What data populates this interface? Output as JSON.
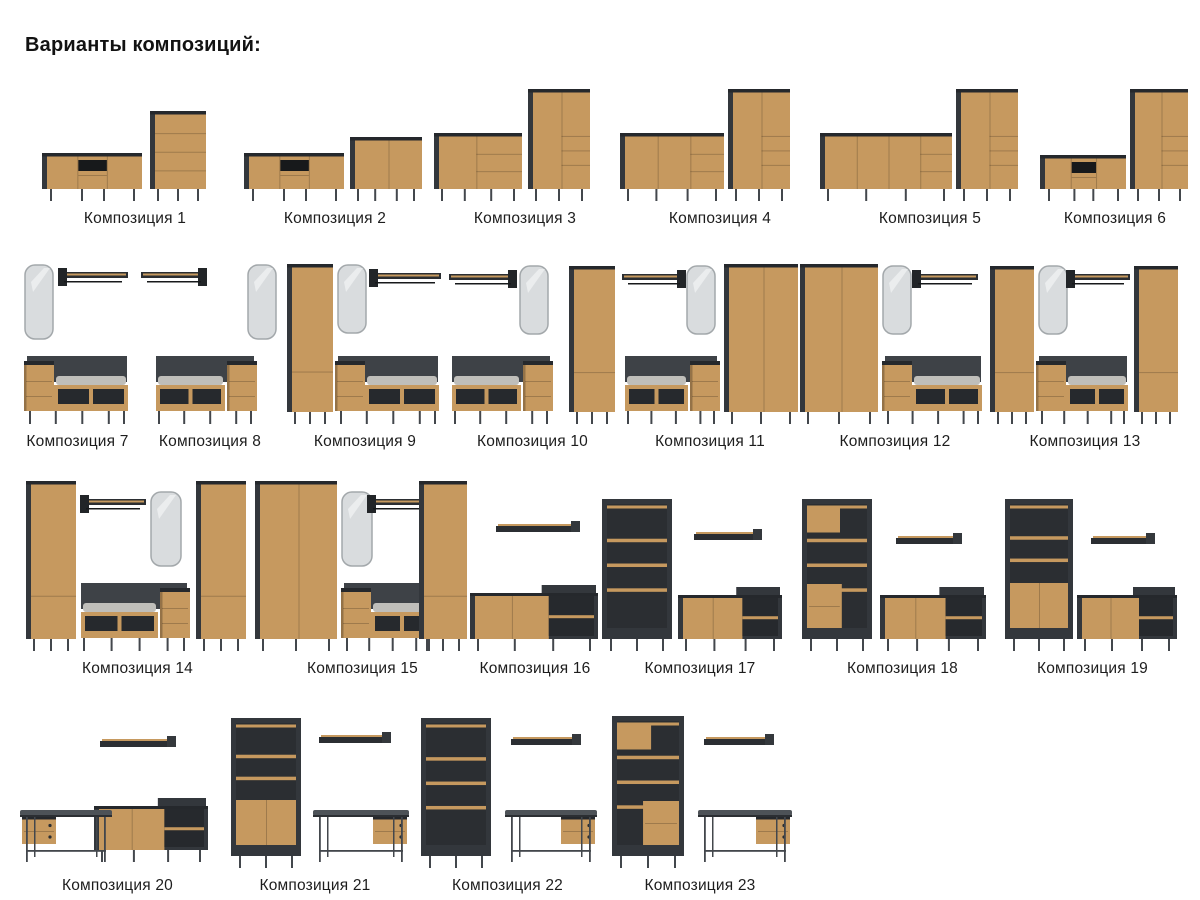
{
  "page": {
    "title": "Варианты композиций:"
  },
  "colors": {
    "oak": "#c6995f",
    "carcass": "#33373c",
    "carcassDark": "#25282c",
    "inner": "#26292d",
    "leg": "#43474c",
    "cushion": "#bfbeba",
    "mirror": "#d9dcde",
    "deskTop": "#4d5257",
    "ink": "#1d1d1d"
  },
  "rows": [
    {
      "canvas_h": 118,
      "pad": 30,
      "cells": [
        {
          "w": 210,
          "label": "Композиция 1",
          "pieces": [
            {
              "t": "tvstand",
              "x": 12,
              "w": 100,
              "h": 36
            },
            {
              "t": "dresser",
              "x": 120,
              "w": 56,
              "h": 78
            }
          ]
        },
        {
          "w": 190,
          "label": "Композиция 2",
          "pieces": [
            {
              "t": "tvstand",
              "x": 4,
              "w": 100,
              "h": 36
            },
            {
              "t": "sideboard",
              "x": 110,
              "w": 72,
              "h": 52,
              "v": [
                0.5
              ]
            }
          ]
        },
        {
          "w": 190,
          "label": "Композиция 3",
          "pieces": [
            {
              "t": "sideboard",
              "x": 4,
              "w": 88,
              "h": 56,
              "v": [
                0.45
              ],
              "dr": true
            },
            {
              "t": "tallcab",
              "x": 98,
              "w": 62,
              "h": 100
            }
          ]
        },
        {
          "w": 200,
          "label": "Композиция 4",
          "pieces": [
            {
              "t": "sideboard",
              "x": 0,
              "w": 104,
              "h": 56,
              "v": [
                0.33,
                0.66
              ],
              "dr": true
            },
            {
              "t": "tallcab",
              "x": 108,
              "w": 62,
              "h": 100
            }
          ]
        },
        {
          "w": 220,
          "label": "Композиция 5",
          "pieces": [
            {
              "t": "sideboard",
              "x": 0,
              "w": 132,
              "h": 56,
              "v": [
                0.25,
                0.5,
                0.75
              ],
              "dr": true
            },
            {
              "t": "tallcab",
              "x": 136,
              "w": 62,
              "h": 100
            }
          ]
        },
        {
          "w": 150,
          "label": "Композиция 6",
          "pieces": [
            {
              "t": "tvstand",
              "x": 0,
              "w": 86,
              "h": 34
            },
            {
              "t": "tallcab",
              "x": 90,
              "w": 58,
              "h": 100
            }
          ]
        }
      ]
    },
    {
      "canvas_h": 162,
      "pad": 20,
      "cells": [
        {
          "w": 115,
          "label": "Композиция 7",
          "pieces": [
            {
              "t": "mirror",
              "x": 4,
              "top": 2,
              "w": 30,
              "h": 76
            },
            {
              "t": "hanger",
              "x": 38,
              "top": 6,
              "w": 70,
              "side": "l"
            },
            {
              "t": "bench",
              "x": 4,
              "w": 106,
              "side": "left"
            }
          ]
        },
        {
          "w": 150,
          "label": "Композиция 8",
          "pieces": [
            {
              "t": "hanger",
              "x": 6,
              "top": 6,
              "w": 66,
              "side": "r"
            },
            {
              "t": "mirror",
              "x": 112,
              "top": 2,
              "w": 30,
              "h": 76
            },
            {
              "t": "bench",
              "x": 18,
              "w": 104,
              "side": "right"
            }
          ]
        },
        {
          "w": 160,
          "label": "Композиция 9",
          "pieces": [
            {
              "t": "mirror",
              "x": 52,
              "top": 2,
              "w": 30,
              "h": 70
            },
            {
              "t": "hanger",
              "x": 84,
              "top": 7,
              "w": 72,
              "side": "l"
            },
            {
              "t": "wardrobe",
              "x": 2,
              "w": 46,
              "h": 148,
              "doors": 1
            },
            {
              "t": "bench",
              "x": 50,
              "w": 106,
              "side": "left"
            }
          ]
        },
        {
          "w": 175,
          "label": "Композиция 10",
          "pieces": [
            {
              "t": "hanger",
              "x": 4,
              "top": 8,
              "w": 68,
              "side": "r"
            },
            {
              "t": "mirror",
              "x": 74,
              "top": 3,
              "w": 30,
              "h": 70
            },
            {
              "t": "bench",
              "x": 4,
              "w": 104,
              "side": "right"
            },
            {
              "t": "wardrobe",
              "x": 124,
              "w": 46,
              "h": 146,
              "doors": 1
            }
          ]
        },
        {
          "w": 180,
          "label": "Композиция 11",
          "pieces": [
            {
              "t": "hanger",
              "x": 2,
              "top": 8,
              "w": 64,
              "side": "r"
            },
            {
              "t": "mirror",
              "x": 66,
              "top": 3,
              "w": 30,
              "h": 70
            },
            {
              "t": "bench",
              "x": 2,
              "w": 98,
              "side": "right"
            },
            {
              "t": "wardrobe",
              "x": 104,
              "w": 74,
              "h": 148,
              "doors": 2
            }
          ]
        },
        {
          "w": 190,
          "label": "Композиция 12",
          "pieces": [
            {
              "t": "wardrobe",
              "x": 0,
              "w": 78,
              "h": 148,
              "doors": 2
            },
            {
              "t": "mirror",
              "x": 82,
              "top": 3,
              "w": 30,
              "h": 70
            },
            {
              "t": "hanger",
              "x": 112,
              "top": 8,
              "w": 66,
              "side": "l"
            },
            {
              "t": "bench",
              "x": 82,
              "w": 102,
              "side": "left"
            }
          ]
        },
        {
          "w": 190,
          "label": "Композиция 13",
          "pieces": [
            {
              "t": "wardrobe",
              "x": 0,
              "w": 44,
              "h": 146,
              "doors": 1
            },
            {
              "t": "mirror",
              "x": 48,
              "top": 3,
              "w": 30,
              "h": 70
            },
            {
              "t": "hanger",
              "x": 76,
              "top": 8,
              "w": 64,
              "side": "l"
            },
            {
              "t": "bench",
              "x": 46,
              "w": 94,
              "side": "left"
            },
            {
              "t": "wardrobe",
              "x": 144,
              "w": 44,
              "h": 146,
              "doors": 1
            }
          ]
        }
      ]
    },
    {
      "canvas_h": 172,
      "pad": 20,
      "cells": [
        {
          "w": 235,
          "label": "Композиция 14",
          "pieces": [
            {
              "t": "wardrobe",
              "x": 6,
              "w": 50,
              "h": 158,
              "doors": 1
            },
            {
              "t": "hanger",
              "x": 60,
              "top": 16,
              "w": 66,
              "side": "l"
            },
            {
              "t": "mirror",
              "x": 130,
              "top": 12,
              "w": 32,
              "h": 76
            },
            {
              "t": "bench",
              "x": 58,
              "w": 112,
              "side": "right"
            },
            {
              "t": "wardrobe",
              "x": 176,
              "w": 50,
              "h": 158,
              "doors": 1
            }
          ]
        },
        {
          "w": 215,
          "label": "Композиция 15",
          "pieces": [
            {
              "t": "wardrobe",
              "x": 0,
              "w": 82,
              "h": 158,
              "doors": 2
            },
            {
              "t": "mirror",
              "x": 86,
              "top": 12,
              "w": 32,
              "h": 76
            },
            {
              "t": "hanger",
              "x": 112,
              "top": 16,
              "w": 62,
              "side": "l"
            },
            {
              "t": "bench",
              "x": 86,
              "w": 94,
              "side": "left"
            },
            {
              "t": "wardrobe",
              "x": 164,
              "w": 48,
              "h": 158,
              "doors": 1
            }
          ]
        },
        {
          "w": 130,
          "label": "Композиция 16",
          "pieces": [
            {
              "t": "wallshelf",
              "x": 26,
              "top": 42,
              "w": 84
            },
            {
              "t": "sbniche",
              "x": 0,
              "w": 128,
              "h": 46
            }
          ]
        },
        {
          "w": 200,
          "label": "Композиция 17",
          "pieces": [
            {
              "t": "bookcase",
              "x": 2,
              "w": 70,
              "h": 140,
              "mode": "open"
            },
            {
              "t": "wallshelf",
              "x": 94,
              "top": 50,
              "w": 68
            },
            {
              "t": "sbniche",
              "x": 78,
              "w": 104,
              "h": 44
            }
          ]
        },
        {
          "w": 205,
          "label": "Композиция 18",
          "pieces": [
            {
              "t": "bookcase",
              "x": 2,
              "w": 70,
              "h": 140,
              "mode": "mixed",
              "box": "left"
            },
            {
              "t": "wallshelf",
              "x": 96,
              "top": 54,
              "w": 66
            },
            {
              "t": "sbniche",
              "x": 80,
              "w": 106,
              "h": 44
            }
          ]
        },
        {
          "w": 175,
          "label": "Композиция 19",
          "pieces": [
            {
              "t": "bookcase",
              "x": 0,
              "w": 68,
              "h": 140,
              "mode": "doors"
            },
            {
              "t": "wallshelf",
              "x": 86,
              "top": 54,
              "w": 64
            },
            {
              "t": "sbniche",
              "x": 72,
              "w": 100,
              "h": 44
            }
          ]
        }
      ]
    },
    {
      "canvas_h": 156,
      "pad": 20,
      "cells": [
        {
          "w": 195,
          "label": "Композиция 20",
          "pieces": [
            {
              "t": "wallshelf",
              "x": 80,
              "top": 24,
              "w": 76
            },
            {
              "t": "sbniche",
              "x": 74,
              "w": 114,
              "h": 44,
              "bottom": 6
            },
            {
              "t": "desk",
              "x": 0,
              "w": 92,
              "side": "left"
            }
          ]
        },
        {
          "w": 200,
          "label": "Композиция 21",
          "pieces": [
            {
              "t": "bookcase",
              "x": 16,
              "w": 70,
              "h": 138,
              "mode": "doors"
            },
            {
              "t": "wallshelf",
              "x": 104,
              "top": 20,
              "w": 72
            },
            {
              "t": "desk",
              "x": 98,
              "w": 96,
              "side": "right"
            }
          ]
        },
        {
          "w": 185,
          "label": "Композиция 22",
          "pieces": [
            {
              "t": "bookcase",
              "x": 6,
              "w": 70,
              "h": 138,
              "mode": "open"
            },
            {
              "t": "wallshelf",
              "x": 96,
              "top": 22,
              "w": 70
            },
            {
              "t": "desk",
              "x": 90,
              "w": 92,
              "side": "right"
            }
          ]
        },
        {
          "w": 200,
          "label": "Композиция 23",
          "pieces": [
            {
              "t": "bookcase",
              "x": 12,
              "w": 72,
              "h": 140,
              "mode": "mixed",
              "box": "right"
            },
            {
              "t": "wallshelf",
              "x": 104,
              "top": 22,
              "w": 70
            },
            {
              "t": "desk",
              "x": 98,
              "w": 94,
              "side": "right"
            }
          ]
        }
      ]
    }
  ]
}
